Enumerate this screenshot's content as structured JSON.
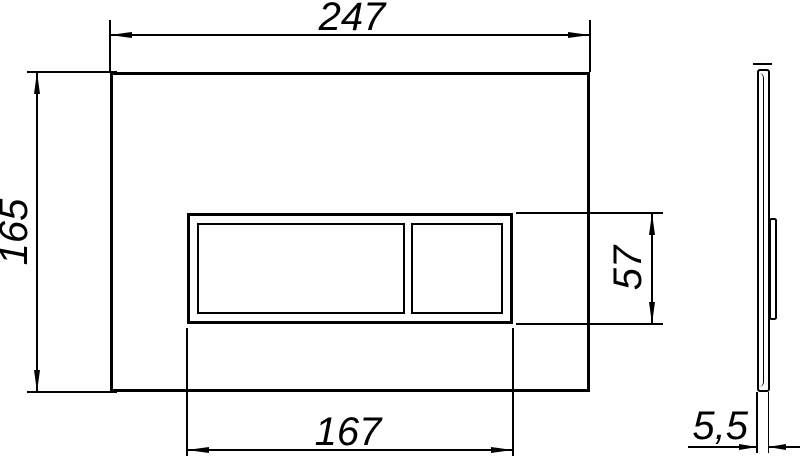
{
  "drawing": {
    "type": "technical-dimension-drawing",
    "subject": "wc-flush-plate",
    "background_color": "#ffffff",
    "line_color": "#000000",
    "views": {
      "front": "front view with two flush buttons",
      "side": "side profile view"
    },
    "dimensions": {
      "overall_width": "247",
      "overall_height": "165",
      "button_panel_width": "167",
      "button_panel_height": "57",
      "plate_thickness": "5,5"
    }
  }
}
